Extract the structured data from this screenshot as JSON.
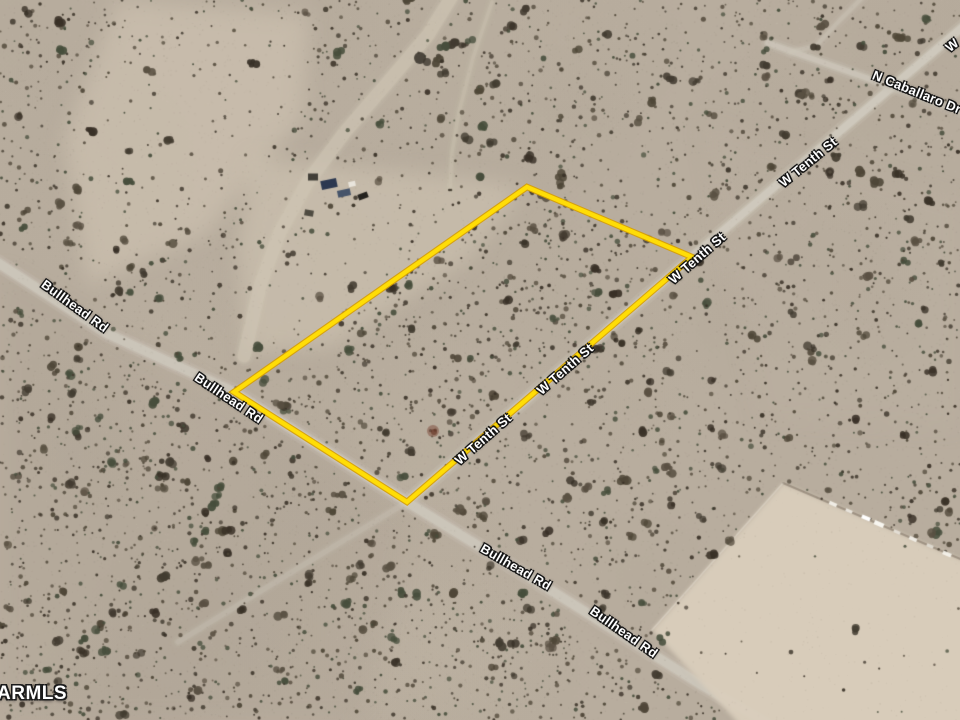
{
  "map": {
    "watermark": "ARMLS",
    "parcel_outline": {
      "color": "#ffdd06",
      "edge_color": "#d79e00",
      "points": [
        [
          527,
          187
        ],
        [
          692,
          257
        ],
        [
          407,
          502
        ],
        [
          234,
          392
        ]
      ]
    },
    "road_labels": [
      {
        "road": "Bullhead Rd",
        "text": "Bullhead Rd",
        "x": 75,
        "y": 306,
        "angle": 36
      },
      {
        "road": "Bullhead Rd",
        "text": "Bullhead Rd",
        "x": 229,
        "y": 398,
        "angle": 34
      },
      {
        "road": "Bullhead Rd",
        "text": "Bullhead Rd",
        "x": 516,
        "y": 567,
        "angle": 30
      },
      {
        "road": "Bullhead Rd",
        "text": "Bullhead Rd",
        "x": 624,
        "y": 632,
        "angle": 35
      },
      {
        "road": "W Tenth St",
        "text": "W Tenth St",
        "x": 483,
        "y": 439,
        "angle": -41
      },
      {
        "road": "W Tenth St",
        "text": "W Tenth St",
        "x": 565,
        "y": 369,
        "angle": -41
      },
      {
        "road": "W Tenth St",
        "text": "W Tenth St",
        "x": 697,
        "y": 258,
        "angle": -41
      },
      {
        "road": "W Tenth St",
        "text": "W Tenth St",
        "x": 808,
        "y": 162,
        "angle": -39
      },
      {
        "road": "N Caballaro Dr",
        "text": "N Caballaro Dr",
        "x": 917,
        "y": 92,
        "angle": 22
      },
      {
        "road": "W Tenth St",
        "text": "W",
        "x": 952,
        "y": 45,
        "angle": -39
      }
    ],
    "roads": [
      {
        "name": "Bullhead Rd",
        "path": [
          [
            -25,
            248
          ],
          [
            108,
            334
          ],
          [
            234,
            392
          ],
          [
            407,
            502
          ],
          [
            560,
            596
          ],
          [
            700,
            684
          ],
          [
            800,
            742
          ]
        ],
        "width": 9,
        "opacity": 0.9,
        "color": "#ccc6ba",
        "clear": 8
      },
      {
        "name": "W Tenth St",
        "path": [
          [
            407,
            502
          ],
          [
            692,
            257
          ],
          [
            965,
            25
          ]
        ],
        "width": 7.5,
        "opacity": 0.85,
        "color": "#d0cabe",
        "clear": 7
      },
      {
        "name": "W Tenth St sw trail",
        "path": [
          [
            407,
            502
          ],
          [
            300,
            567
          ],
          [
            178,
            642
          ]
        ],
        "width": 5,
        "opacity": 0.28,
        "color": "#ccc6ba",
        "clear": 4
      },
      {
        "name": "N Caballaro Dr",
        "path": [
          [
            768,
            43
          ],
          [
            985,
            120
          ]
        ],
        "width": 5.5,
        "opacity": 0.75,
        "color": "#ccc6ba",
        "clear": 5
      },
      {
        "name": "N Caballaro Dr spur",
        "path": [
          [
            866,
            -6
          ],
          [
            840,
            20
          ],
          [
            816,
            46
          ],
          [
            790,
            52
          ]
        ],
        "width": 4,
        "opacity": 0.4,
        "color": "#ccc6ba",
        "clear": 3
      },
      {
        "name": "wash road",
        "path": [
          [
            457,
            -12
          ],
          [
            428,
            35
          ],
          [
            388,
            82
          ],
          [
            345,
            132
          ],
          [
            307,
            183
          ],
          [
            280,
            232
          ],
          [
            261,
            283
          ],
          [
            250,
            330
          ],
          [
            244,
            356
          ]
        ],
        "width": 13,
        "opacity": 0.5,
        "color": "#cfc6b5",
        "clear": 9
      },
      {
        "name": "wash trail",
        "path": [
          [
            492,
            2
          ],
          [
            473,
            58
          ],
          [
            459,
            112
          ],
          [
            452,
            152
          ],
          [
            450,
            188
          ]
        ],
        "width": 3.5,
        "opacity": 0.3,
        "color": "#cfc6b5",
        "clear": 2
      }
    ],
    "cleared_lot": {
      "color": "#d9cdbc",
      "alpha": 0.95,
      "points": [
        [
          783,
          483
        ],
        [
          965,
          561
        ],
        [
          965,
          725
        ],
        [
          740,
          725
        ],
        [
          652,
          630
        ]
      ],
      "ne_edge": [
        [
          783,
          483
        ],
        [
          965,
          561
        ]
      ],
      "nw_edge": [
        [
          783,
          483
        ],
        [
          652,
          630
        ]
      ]
    },
    "terrain": {
      "seed": 20240613,
      "base_color": "#b8ad9e",
      "speck_dark": "70,62,52",
      "speck_light": "236,228,214",
      "shrub_colors": [
        "#433c31",
        "#4f4738",
        "#393127",
        "#5a5143",
        "#474e3c"
      ],
      "patches": [
        {
          "name": "upper-left-wash",
          "color": "#d6cab7",
          "alpha": 0.5,
          "points": [
            [
              118,
              0
            ],
            [
              310,
              14
            ],
            [
              302,
              118
            ],
            [
              205,
              235
            ],
            [
              88,
              285
            ],
            [
              64,
              140
            ]
          ]
        },
        {
          "name": "north-cleared-band",
          "color": "#d2c7b4",
          "alpha": 0.55,
          "points": [
            [
              252,
              158
            ],
            [
              470,
              178
            ],
            [
              525,
              188
            ],
            [
              470,
              258
            ],
            [
              330,
              348
            ],
            [
              246,
              352
            ],
            [
              238,
              248
            ]
          ]
        },
        {
          "name": "bottom-left-darker",
          "color": "#a2988a",
          "alpha": 0.16,
          "points": [
            [
              0,
              268
            ],
            [
              230,
              400
            ],
            [
              415,
              515
            ],
            [
              360,
              720
            ],
            [
              0,
              720
            ]
          ]
        },
        {
          "name": "right-mid-tint",
          "color": "#c2b6a5",
          "alpha": 0.15,
          "points": [
            [
              700,
              120
            ],
            [
              960,
              200
            ],
            [
              960,
              430
            ],
            [
              760,
              420
            ]
          ]
        }
      ]
    },
    "objects": [
      {
        "type": "rect",
        "x": 329,
        "y": 184,
        "w": 16,
        "h": 9,
        "angle": -12,
        "color": "#2c3850",
        "alpha": 1
      },
      {
        "type": "rect",
        "x": 344,
        "y": 193,
        "w": 13,
        "h": 7,
        "angle": -12,
        "color": "#46546a",
        "alpha": 1
      },
      {
        "type": "rect",
        "x": 352,
        "y": 184,
        "w": 7,
        "h": 5,
        "angle": -12,
        "color": "#e9e5dc",
        "alpha": 1
      },
      {
        "type": "rect",
        "x": 363,
        "y": 196,
        "w": 10,
        "h": 6,
        "angle": -20,
        "color": "#24221e",
        "alpha": 1
      },
      {
        "type": "rect",
        "x": 313,
        "y": 177,
        "w": 10,
        "h": 7,
        "angle": 0,
        "color": "#33312b",
        "alpha": 0.9
      },
      {
        "type": "rect",
        "x": 309,
        "y": 213,
        "w": 9,
        "h": 6,
        "angle": 10,
        "color": "#3a372f",
        "alpha": 0.85
      },
      {
        "type": "rect",
        "x": 833,
        "y": 504,
        "w": 8,
        "h": 3.5,
        "angle": 23,
        "color": "#f4f1ea",
        "alpha": 0.95
      },
      {
        "type": "rect",
        "x": 849,
        "y": 511,
        "w": 7,
        "h": 3,
        "angle": 23,
        "color": "#efece4",
        "alpha": 0.9
      },
      {
        "type": "rect",
        "x": 866,
        "y": 518,
        "w": 9,
        "h": 4,
        "angle": 23,
        "color": "#ffffff",
        "alpha": 1
      },
      {
        "type": "rect",
        "x": 879,
        "y": 524,
        "w": 10,
        "h": 4.5,
        "angle": 23,
        "color": "#f8f6f0",
        "alpha": 1
      },
      {
        "type": "rect",
        "x": 897,
        "y": 532,
        "w": 7,
        "h": 3,
        "angle": 23,
        "color": "#eae6dd",
        "alpha": 0.9
      },
      {
        "type": "rect",
        "x": 913,
        "y": 539,
        "w": 8,
        "h": 3.5,
        "angle": 23,
        "color": "#f2efe8",
        "alpha": 0.95
      },
      {
        "type": "rect",
        "x": 930,
        "y": 546,
        "w": 7,
        "h": 3,
        "angle": 23,
        "color": "#e8e4da",
        "alpha": 0.85
      },
      {
        "type": "rect",
        "x": 947,
        "y": 554,
        "w": 9,
        "h": 4,
        "angle": 23,
        "color": "#f6f3ec",
        "alpha": 0.95
      },
      {
        "type": "dot",
        "x": 433,
        "y": 431,
        "r": 6,
        "color": "#7a4636",
        "alpha": 0.5
      },
      {
        "type": "dot",
        "x": 434,
        "y": 432,
        "r": 3,
        "color": "#63301f",
        "alpha": 0.6
      },
      {
        "type": "dot",
        "x": 420,
        "y": 58,
        "r": 6,
        "color": "#37322a",
        "alpha": 0.85
      },
      {
        "type": "dot",
        "x": 427,
        "y": 62,
        "r": 4,
        "color": "#3e382f",
        "alpha": 0.8
      }
    ]
  }
}
